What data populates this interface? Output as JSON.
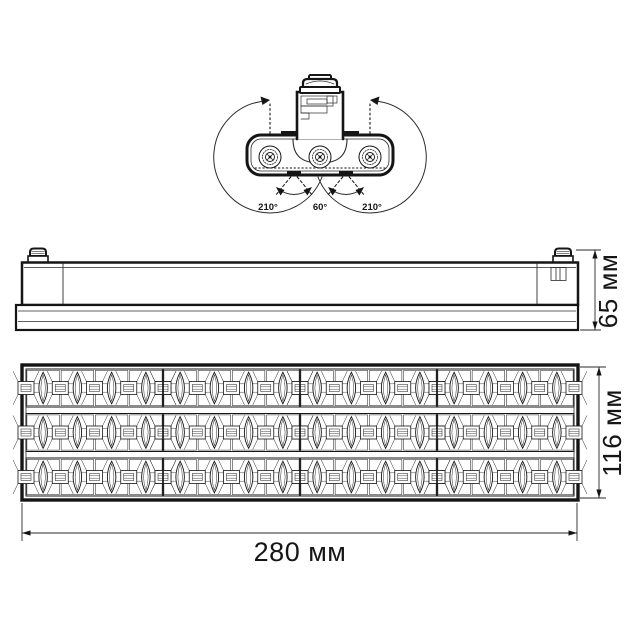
{
  "page": {
    "background": "#ffffff",
    "line_color": "#151515",
    "thin_line_color": "#2b2b2b",
    "dim_line_color": "#2a2a2a"
  },
  "rotation_view": {
    "description_icons": [
      "rotation-arc-icon",
      "tilt-arc-icon",
      "pivot-screw-icon"
    ],
    "labels": {
      "left_angle": "210°",
      "center_angle": "60°",
      "right_angle": "210°"
    },
    "angles_deg": [
      210,
      60,
      210
    ]
  },
  "side_view": {
    "height_label": "65 мм",
    "height_mm": 65
  },
  "front_view": {
    "height_label": "116 мм",
    "height_mm": 116,
    "width_label": "280 мм",
    "width_mm": 280,
    "grid": {
      "rows": 3,
      "groups": 4,
      "cells_per_group": 4,
      "columns": 16
    }
  }
}
